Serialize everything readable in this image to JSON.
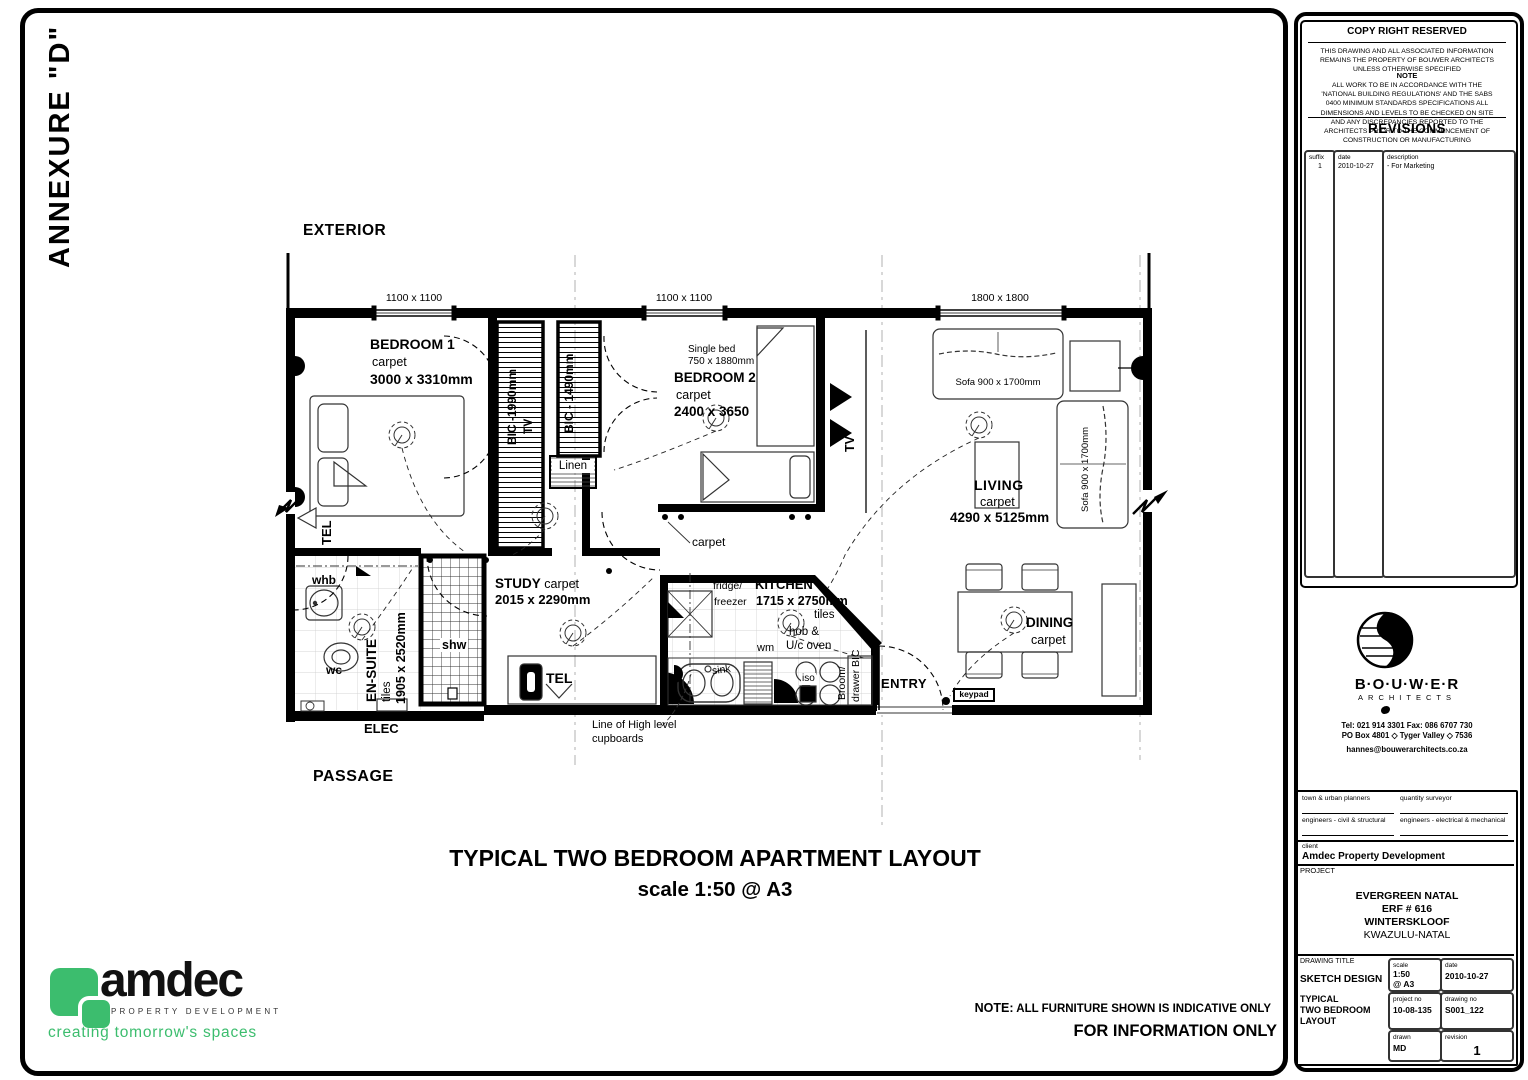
{
  "annexure": "ANNEXURE \"D\"",
  "plan": {
    "exterior_label": "EXTERIOR",
    "passage_label": "PASSAGE",
    "windows": [
      {
        "label": "1100 x 1100"
      },
      {
        "label": "1100 x 1100"
      },
      {
        "label": "1800 x 1800"
      }
    ],
    "bedroom1": {
      "name": "BEDROOM 1",
      "finish": "carpet",
      "dims": "3000 x 3310mm",
      "tel": "TEL"
    },
    "bic1": {
      "label": "BIC -1990mm",
      "tv": "TV"
    },
    "bic2": {
      "label": "BIC - 1490mm"
    },
    "linen": "Linen",
    "bedroom2": {
      "bed": "Single bed",
      "bed_dims": "750 x 1880mm",
      "name": "BEDROOM 2",
      "finish": "carpet",
      "dims": "2400 x 3650"
    },
    "tv": "TV",
    "living": {
      "name": "LIVING",
      "finish": "carpet",
      "dims": "4290 x 5125mm",
      "sofa1": "Sofa 900 x 1700mm",
      "sofa2": "Sofa 900 x 1700mm"
    },
    "hall_carpet": "carpet",
    "ensuite": {
      "whb": "whb",
      "wc": "wc",
      "name": "EN-SUITE",
      "finish": "tiles",
      "dims": "1905 x 2520mm",
      "shower": "shw"
    },
    "elec": "ELEC",
    "study": {
      "name": "STUDY",
      "finish": "carpet",
      "dims": "2015 x 2290mm",
      "tel": "TEL"
    },
    "kitchen": {
      "fridge1": "fridge/",
      "fridge2": "freezer",
      "name": "KITCHEN",
      "dims": "1715 x 2750mm",
      "finish": "tiles",
      "hob1": "hob &",
      "hob2": "U/c oven",
      "wm": "wm",
      "sink": "sink",
      "iso": "iso",
      "broom1": "Broom/",
      "broom2": "drawer BIC",
      "cupboard_note1": "Line of High level",
      "cupboard_note2": "cupboards"
    },
    "entry": {
      "name": "ENTRY",
      "keypad": "keypad"
    },
    "dining": {
      "name": "DINING",
      "finish": "carpet"
    }
  },
  "title": {
    "line1": "TYPICAL TWO BEDROOM APARTMENT LAYOUT",
    "line2": "scale 1:50 @ A3"
  },
  "notes": {
    "prefix": "NOTE:",
    "furniture": "ALL FURNITURE SHOWN IS INDICATIVE ONLY",
    "info": "FOR INFORMATION ONLY"
  },
  "amdec": {
    "name": "amdec",
    "tagline": "PROPERTY DEVELOPMENT",
    "slogan": "creating tomorrow's spaces",
    "green": "#3cbd6e"
  },
  "titleblock": {
    "copyright": "COPY RIGHT RESERVED",
    "disclaimer": "THIS DRAWING AND ALL ASSOCIATED INFORMATION REMAINS THE PROPERTY OF BOUWER ARCHITECTS UNLESS OTHERWISE SPECIFIED",
    "note_title": "NOTE",
    "note_body": "ALL WORK TO BE IN ACCORDANCE WITH THE 'NATIONAL BUILDING REGULATIONS' AND THE SABS 0400 MINIMUM STANDARDS SPECIFICATIONS ALL DIMENSIONS AND LEVELS TO BE CHECKED ON SITE AND ANY DISCREPANCIES REPORTED TO THE ARCHITECTS PRIOR TO THE COMMENCEMENT OF CONSTRUCTION OR MANUFACTURING",
    "revisions_title": "REVISIONS",
    "rev_headers": {
      "suffix": "suffix",
      "date": "date",
      "description": "description"
    },
    "rev_row": {
      "suffix": "1",
      "date": "2010-10-27",
      "description": "- For Marketing"
    },
    "architect": {
      "name": "B·O·U·W·E·R",
      "type": "ARCHITECTS",
      "tel": "Tel: 021 914 3301   Fax: 086 6707 730",
      "po": "PO Box 4801 ◇ Tyger Valley ◇ 7536",
      "email": "hannes@bouwerarchitects.co.za"
    },
    "consultants": {
      "c1": "town & urban planners",
      "c2": "quantity surveyor",
      "c3": "engineers - civil & structural",
      "c4": "engineers - electrical & mechanical"
    },
    "client_label": "client",
    "client": "Amdec Property Development",
    "project_label": "PROJECT",
    "project": {
      "l1": "EVERGREEN NATAL",
      "l2": "ERF # 616",
      "l3": "WINTERSKLOOF",
      "l4": "KWAZULU-NATAL"
    },
    "drawing_title_label": "DRAWING TITLE",
    "drawing_title1": "SKETCH DESIGN",
    "drawing_title2": "TYPICAL",
    "drawing_title3": "TWO BEDROOM",
    "drawing_title4": "LAYOUT",
    "scale_label": "scale",
    "scale1": "1:50",
    "scale2": "@ A3",
    "date_label": "date",
    "date": "2010-10-27",
    "projno_label": "project no",
    "projno": "10-08-135",
    "dwgno_label": "drawing no",
    "dwgno": "S001_122",
    "drawn_label": "drawn",
    "drawn": "MD",
    "rev_label": "revision",
    "rev": "1"
  }
}
